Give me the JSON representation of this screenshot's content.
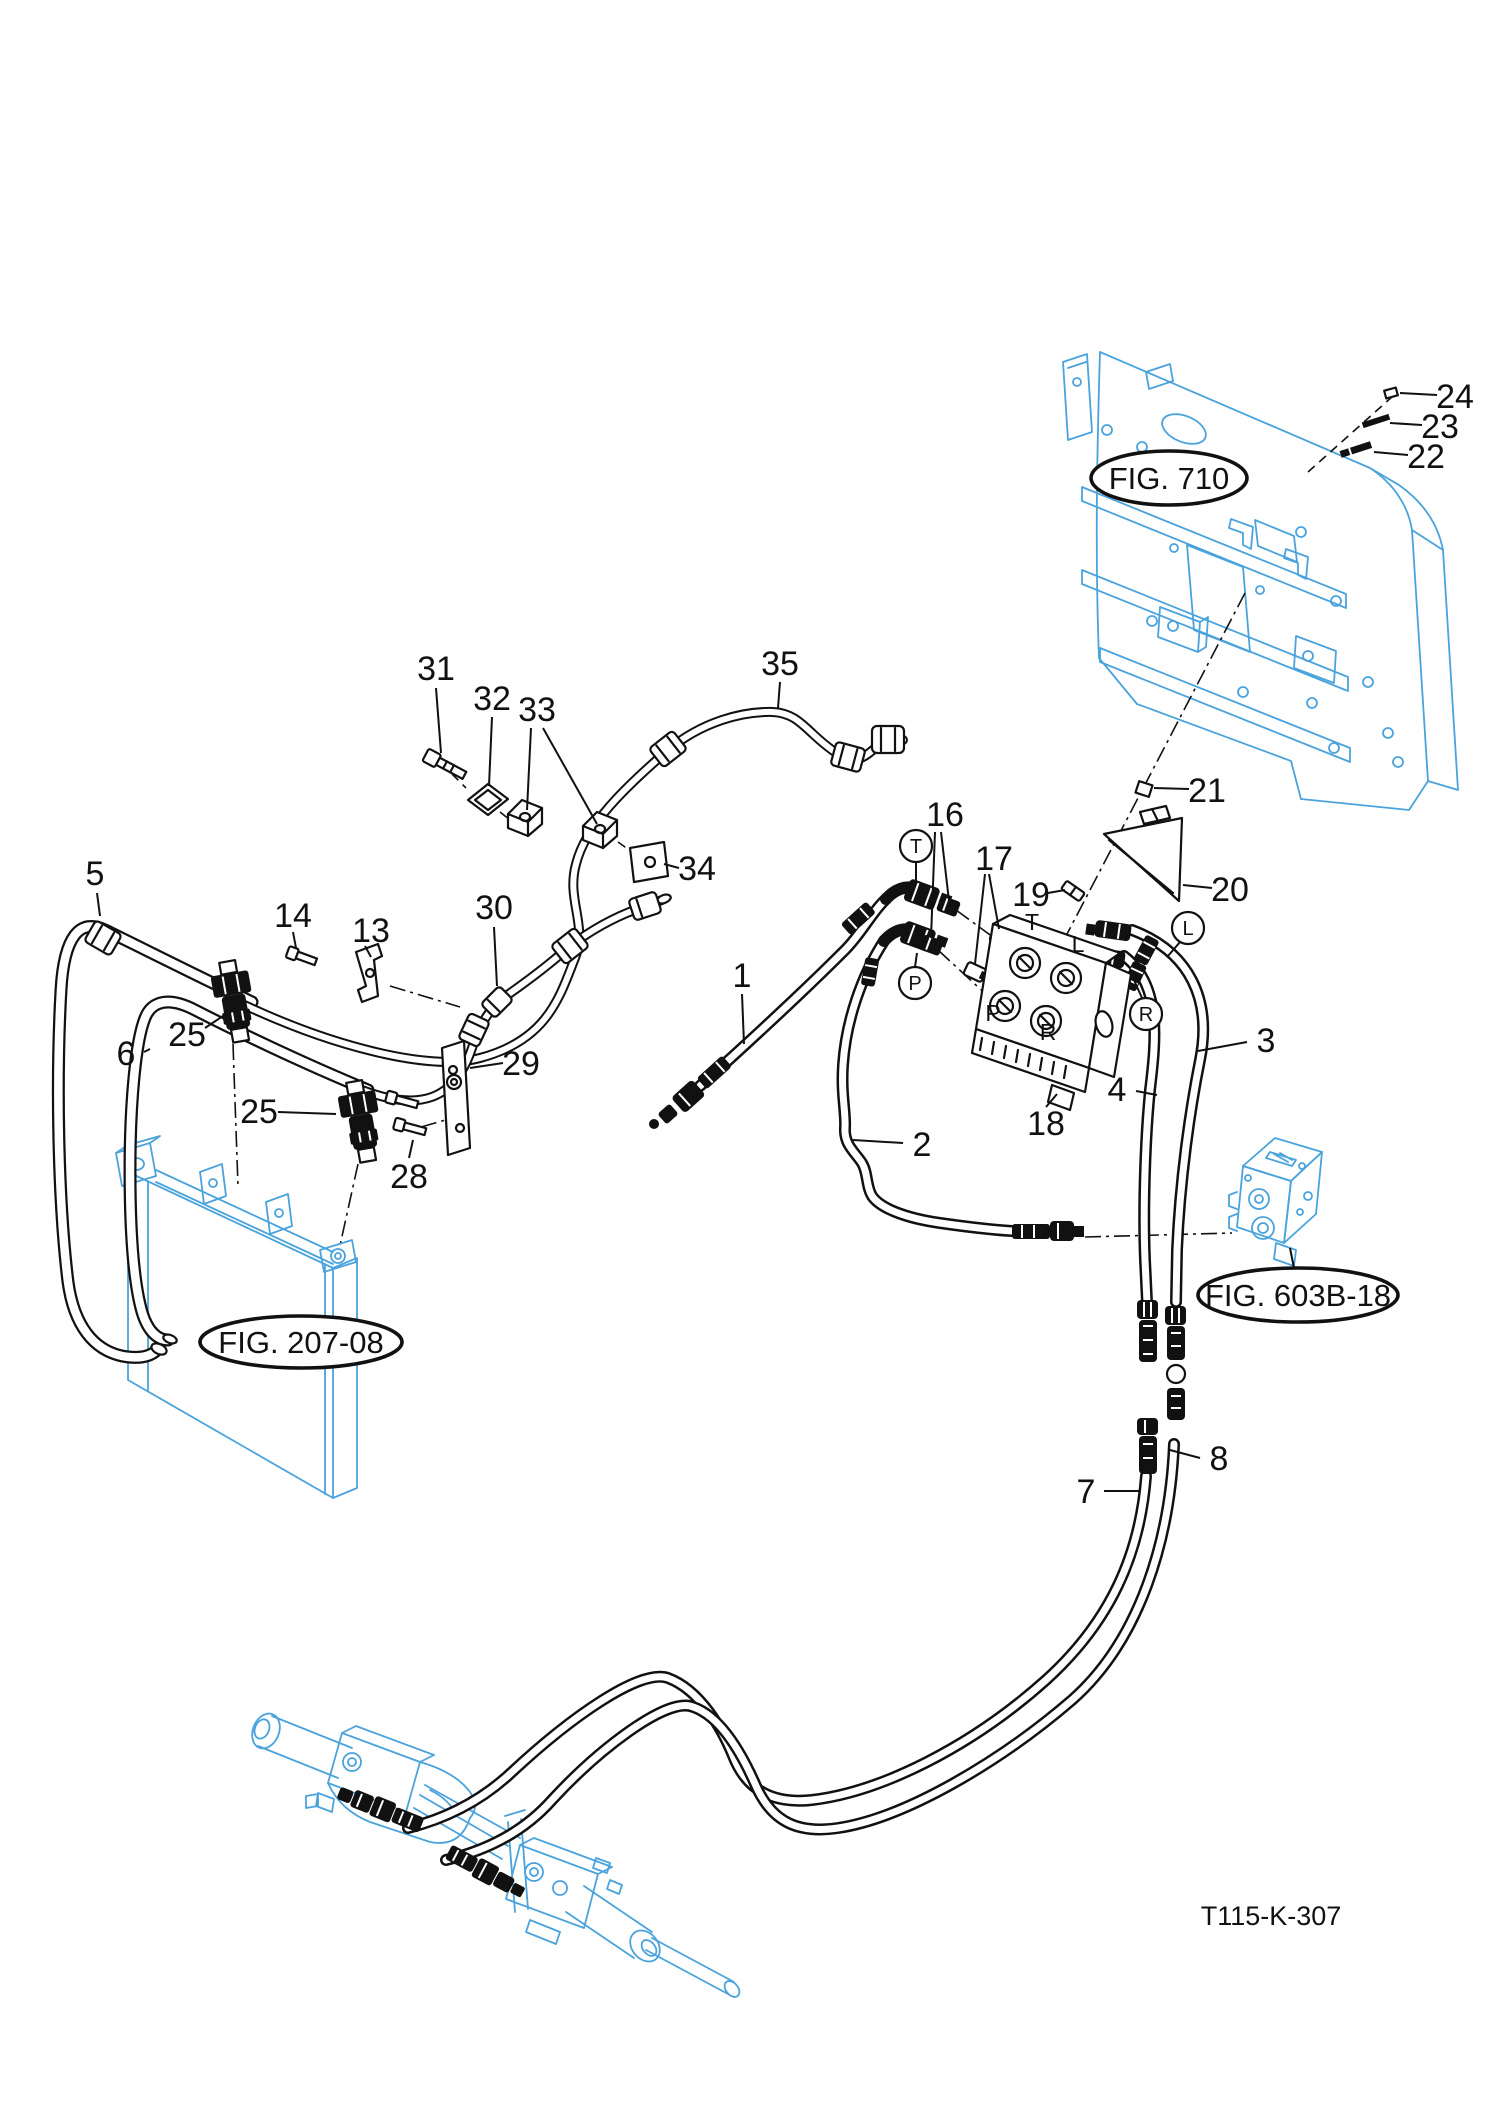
{
  "drawing": {
    "code": "T115-K-307"
  },
  "figure_refs": {
    "fig710": "FIG. 710",
    "fig20708": "FIG. 207-08",
    "fig603b18": "FIG. 603B-18"
  },
  "callouts": {
    "1": "1",
    "2": "2",
    "3": "3",
    "4": "4",
    "5": "5",
    "6": "6",
    "7": "7",
    "8": "8",
    "13": "13",
    "14": "14",
    "16": "16",
    "17": "17",
    "18": "18",
    "19": "19",
    "20": "20",
    "21": "21",
    "22": "22",
    "23": "23",
    "24": "24",
    "25": "25",
    "28": "28",
    "29": "29",
    "30": "30",
    "31": "31",
    "32": "32",
    "33": "33",
    "34": "34",
    "35": "35"
  },
  "valve_ports": {
    "T": "T",
    "L": "L",
    "P": "P",
    "R": "R"
  },
  "hose_tags": {
    "T": "T",
    "P": "P",
    "L": "L",
    "R": "R"
  }
}
